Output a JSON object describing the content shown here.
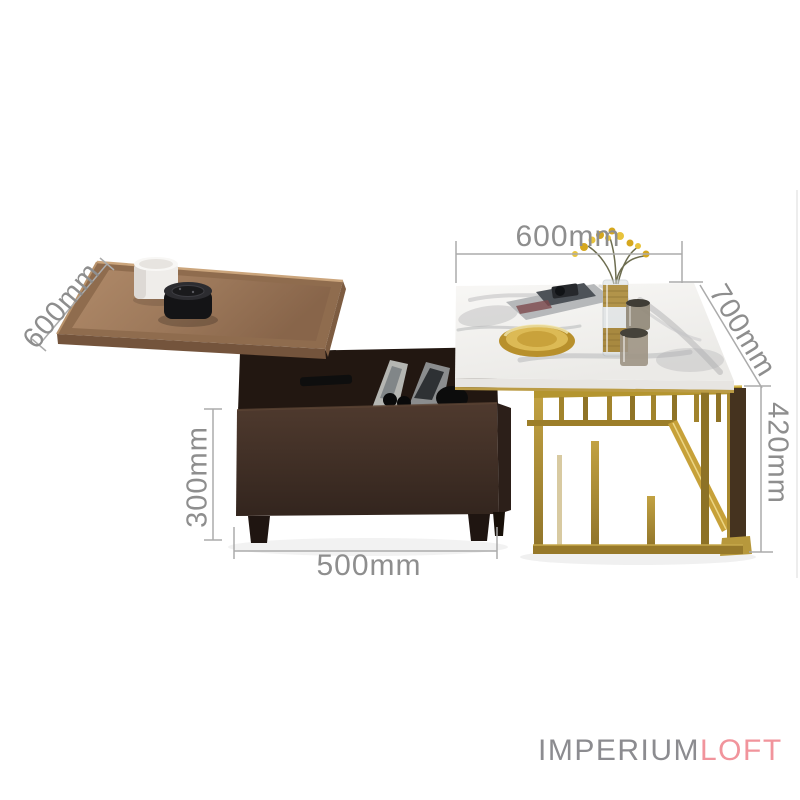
{
  "image_type": "furniture-product-photo-with-dimensions",
  "dims": {
    "left_table_depth": {
      "label": "600mm"
    },
    "right_table_width": {
      "label": "600mm"
    },
    "right_table_depth": {
      "label": "700mm"
    },
    "right_table_height": {
      "label": "420mm"
    },
    "left_table_height": {
      "label": "300mm"
    },
    "left_table_width": {
      "label": "500mm"
    }
  },
  "watermark": {
    "brand_primary": "IMPERIUM",
    "brand_secondary": "LOFT",
    "primary_color": "#8c8c90",
    "secondary_color": "#f1949c"
  },
  "colors": {
    "annotation_text": "#8e8e8e",
    "annotation_line": "#ababab",
    "walnut_wood": "#8f6c4e",
    "dark_walnut_box": "#43302a",
    "marble_top": "#f6f5f3",
    "gold_frame": "#a8892f",
    "background": "#ffffff"
  }
}
